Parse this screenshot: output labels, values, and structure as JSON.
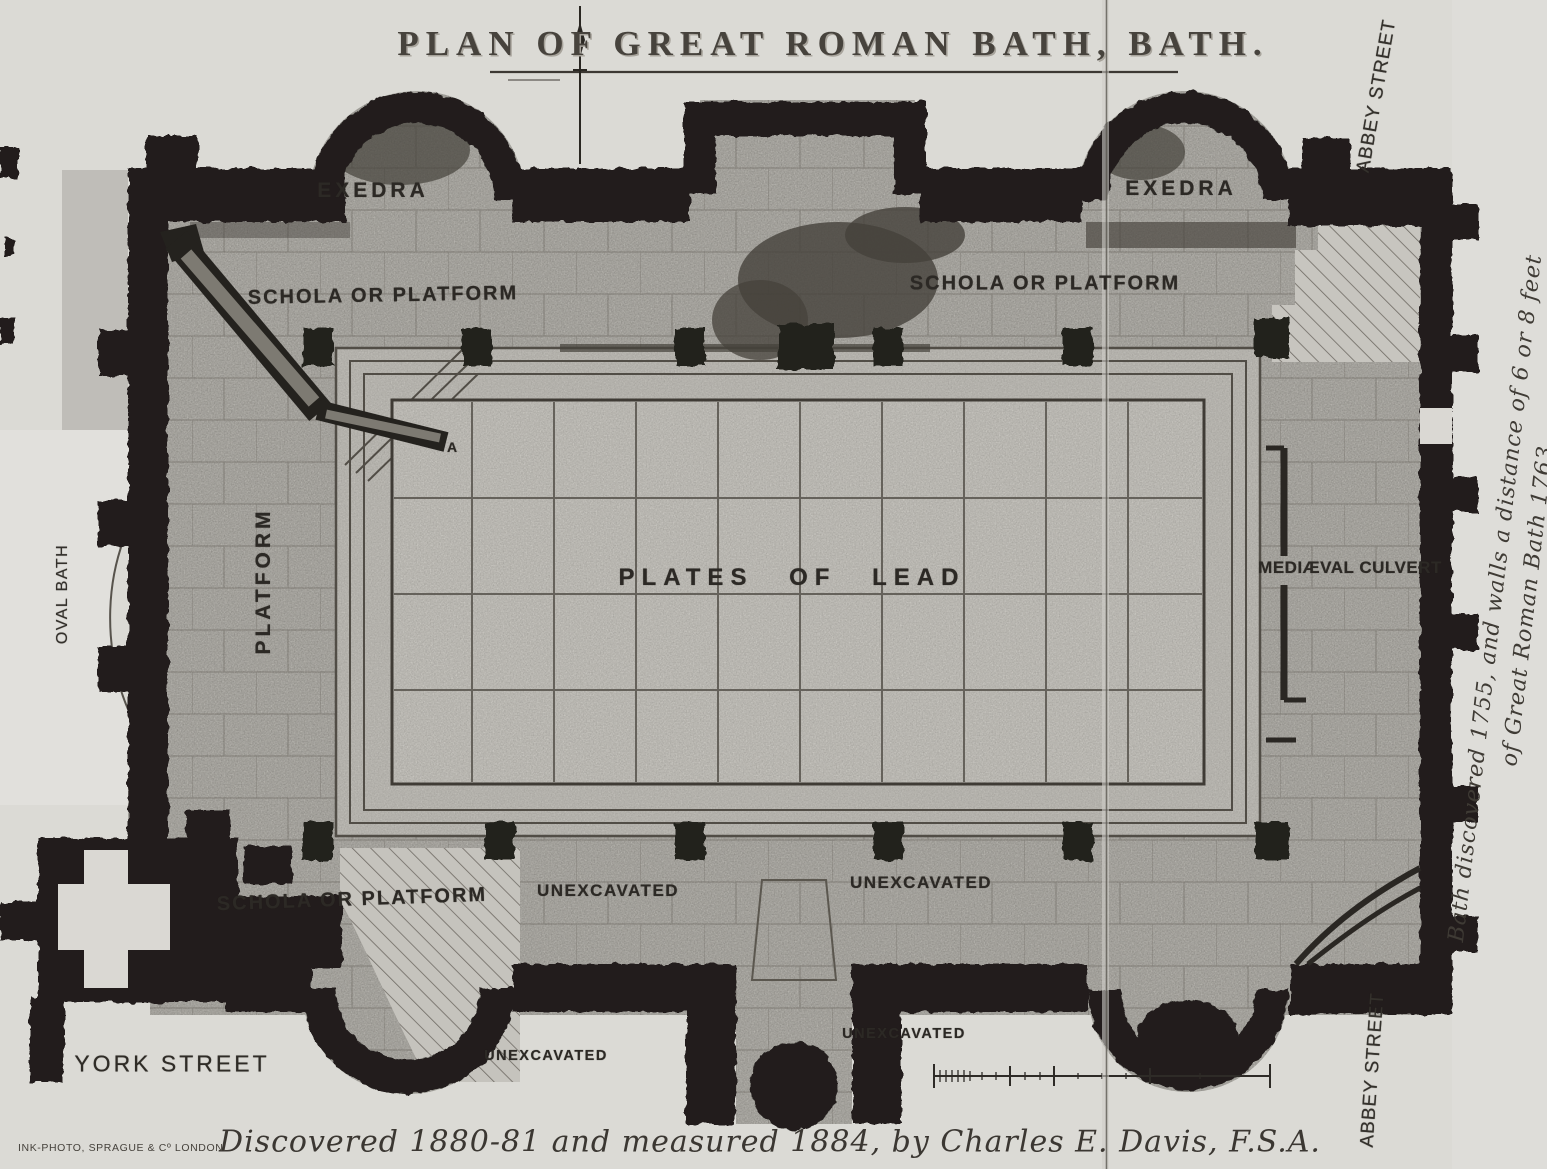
{
  "title": {
    "text": "PLAN OF GREAT ROMAN BATH, BATH."
  },
  "plan": {
    "exedra_left": "EXEDRA",
    "exedra_right": "EXEDRA",
    "schola_top_left": "SCHOLA OR PLATFORM",
    "schola_top_right": "SCHOLA OR PLATFORM",
    "schola_bottom": "SCHOLA OR PLATFORM",
    "platform": "PLATFORM",
    "plates_of_lead": "PLATES OF LEAD",
    "medieval_culvert": "MEDIÆVAL CULVERT",
    "unexcavated_inner_left": "UNEXCAVATED",
    "unexcavated_inner_right": "UNEXCAVATED",
    "unexcavated_outer_left": "UNEXCAVATED",
    "unexcavated_outer_right": "UNEXCAVATED",
    "point_a": "A"
  },
  "streets": {
    "york": "YORK STREET",
    "abbey_top": "ABBEY STREET",
    "abbey_bottom": "ABBEY STREET",
    "oval_bath": "OVAL BATH"
  },
  "margin_note": {
    "line1": "Bath discovered 1755, and walls a distance of  6 or 8 feet",
    "line2": "of Great Roman Bath 1763."
  },
  "caption": "Discovered 1880-81 and measured 1884,  by  Charles E. Davis, F.S.A.",
  "printer": "INK-PHOTO, SPRAGUE & Cº LONDON.",
  "colors": {
    "ink": "#211f1c",
    "paper": "#dbdad5",
    "stone": "#b7b5af"
  }
}
